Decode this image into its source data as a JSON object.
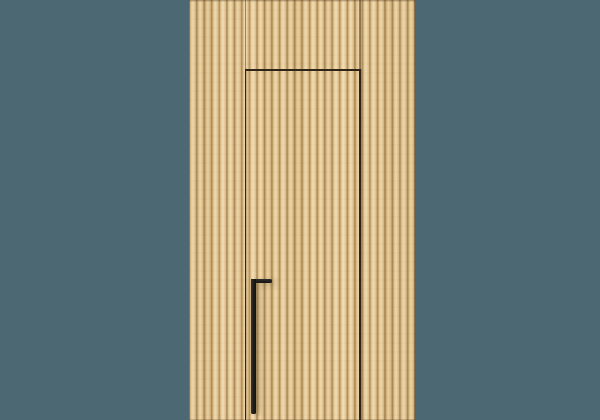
{
  "scene": {
    "description": "Product render of a concealed hidden door built into a vertical wood slat wall panel, with a long black L-shaped pull handle, centered on a flat slate-teal background",
    "colors": {
      "background": "#4c6873",
      "wood_light": "#efd9ac",
      "wood_mid": "#e3c491",
      "wood_mid2": "#dbb87f",
      "wood_dark": "#c19d62",
      "wood_groove": "#a07f4a",
      "seam": "rgba(82,62,32,0.55)",
      "door_gap": "#2e2517",
      "handle": "#201f1e",
      "handle_shadow": "rgba(75,55,28,0.5)"
    }
  }
}
